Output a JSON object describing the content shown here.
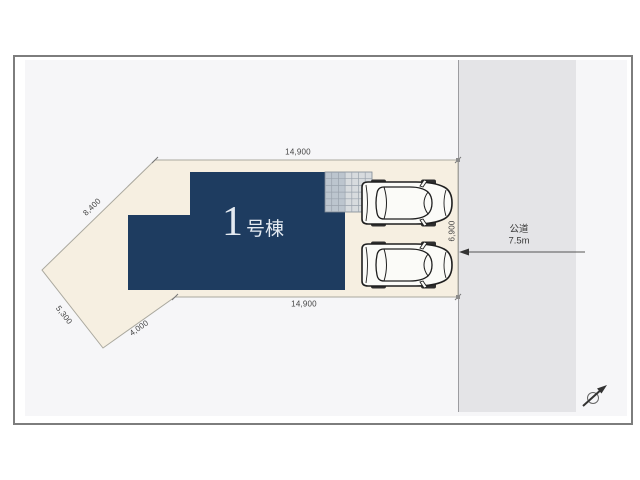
{
  "plan": {
    "building": {
      "number": "1",
      "suffix": "号棟"
    },
    "dimensions": {
      "top_width": "14,900",
      "bottom_width": "14,900",
      "upper_left_edge": "8,400",
      "lower_left_edge": "5,300",
      "lower_bottom_edge": "4,000",
      "right_frontage": "6,900"
    },
    "road": {
      "type": "公道",
      "width": "7.5m"
    },
    "colors": {
      "building": "#1e3c60",
      "lot": "#f6efe1",
      "road": "#e4e4e7",
      "paper": "#f6f6f8",
      "car_body": "#fbfbf8",
      "line": "#1f1f1f"
    }
  }
}
